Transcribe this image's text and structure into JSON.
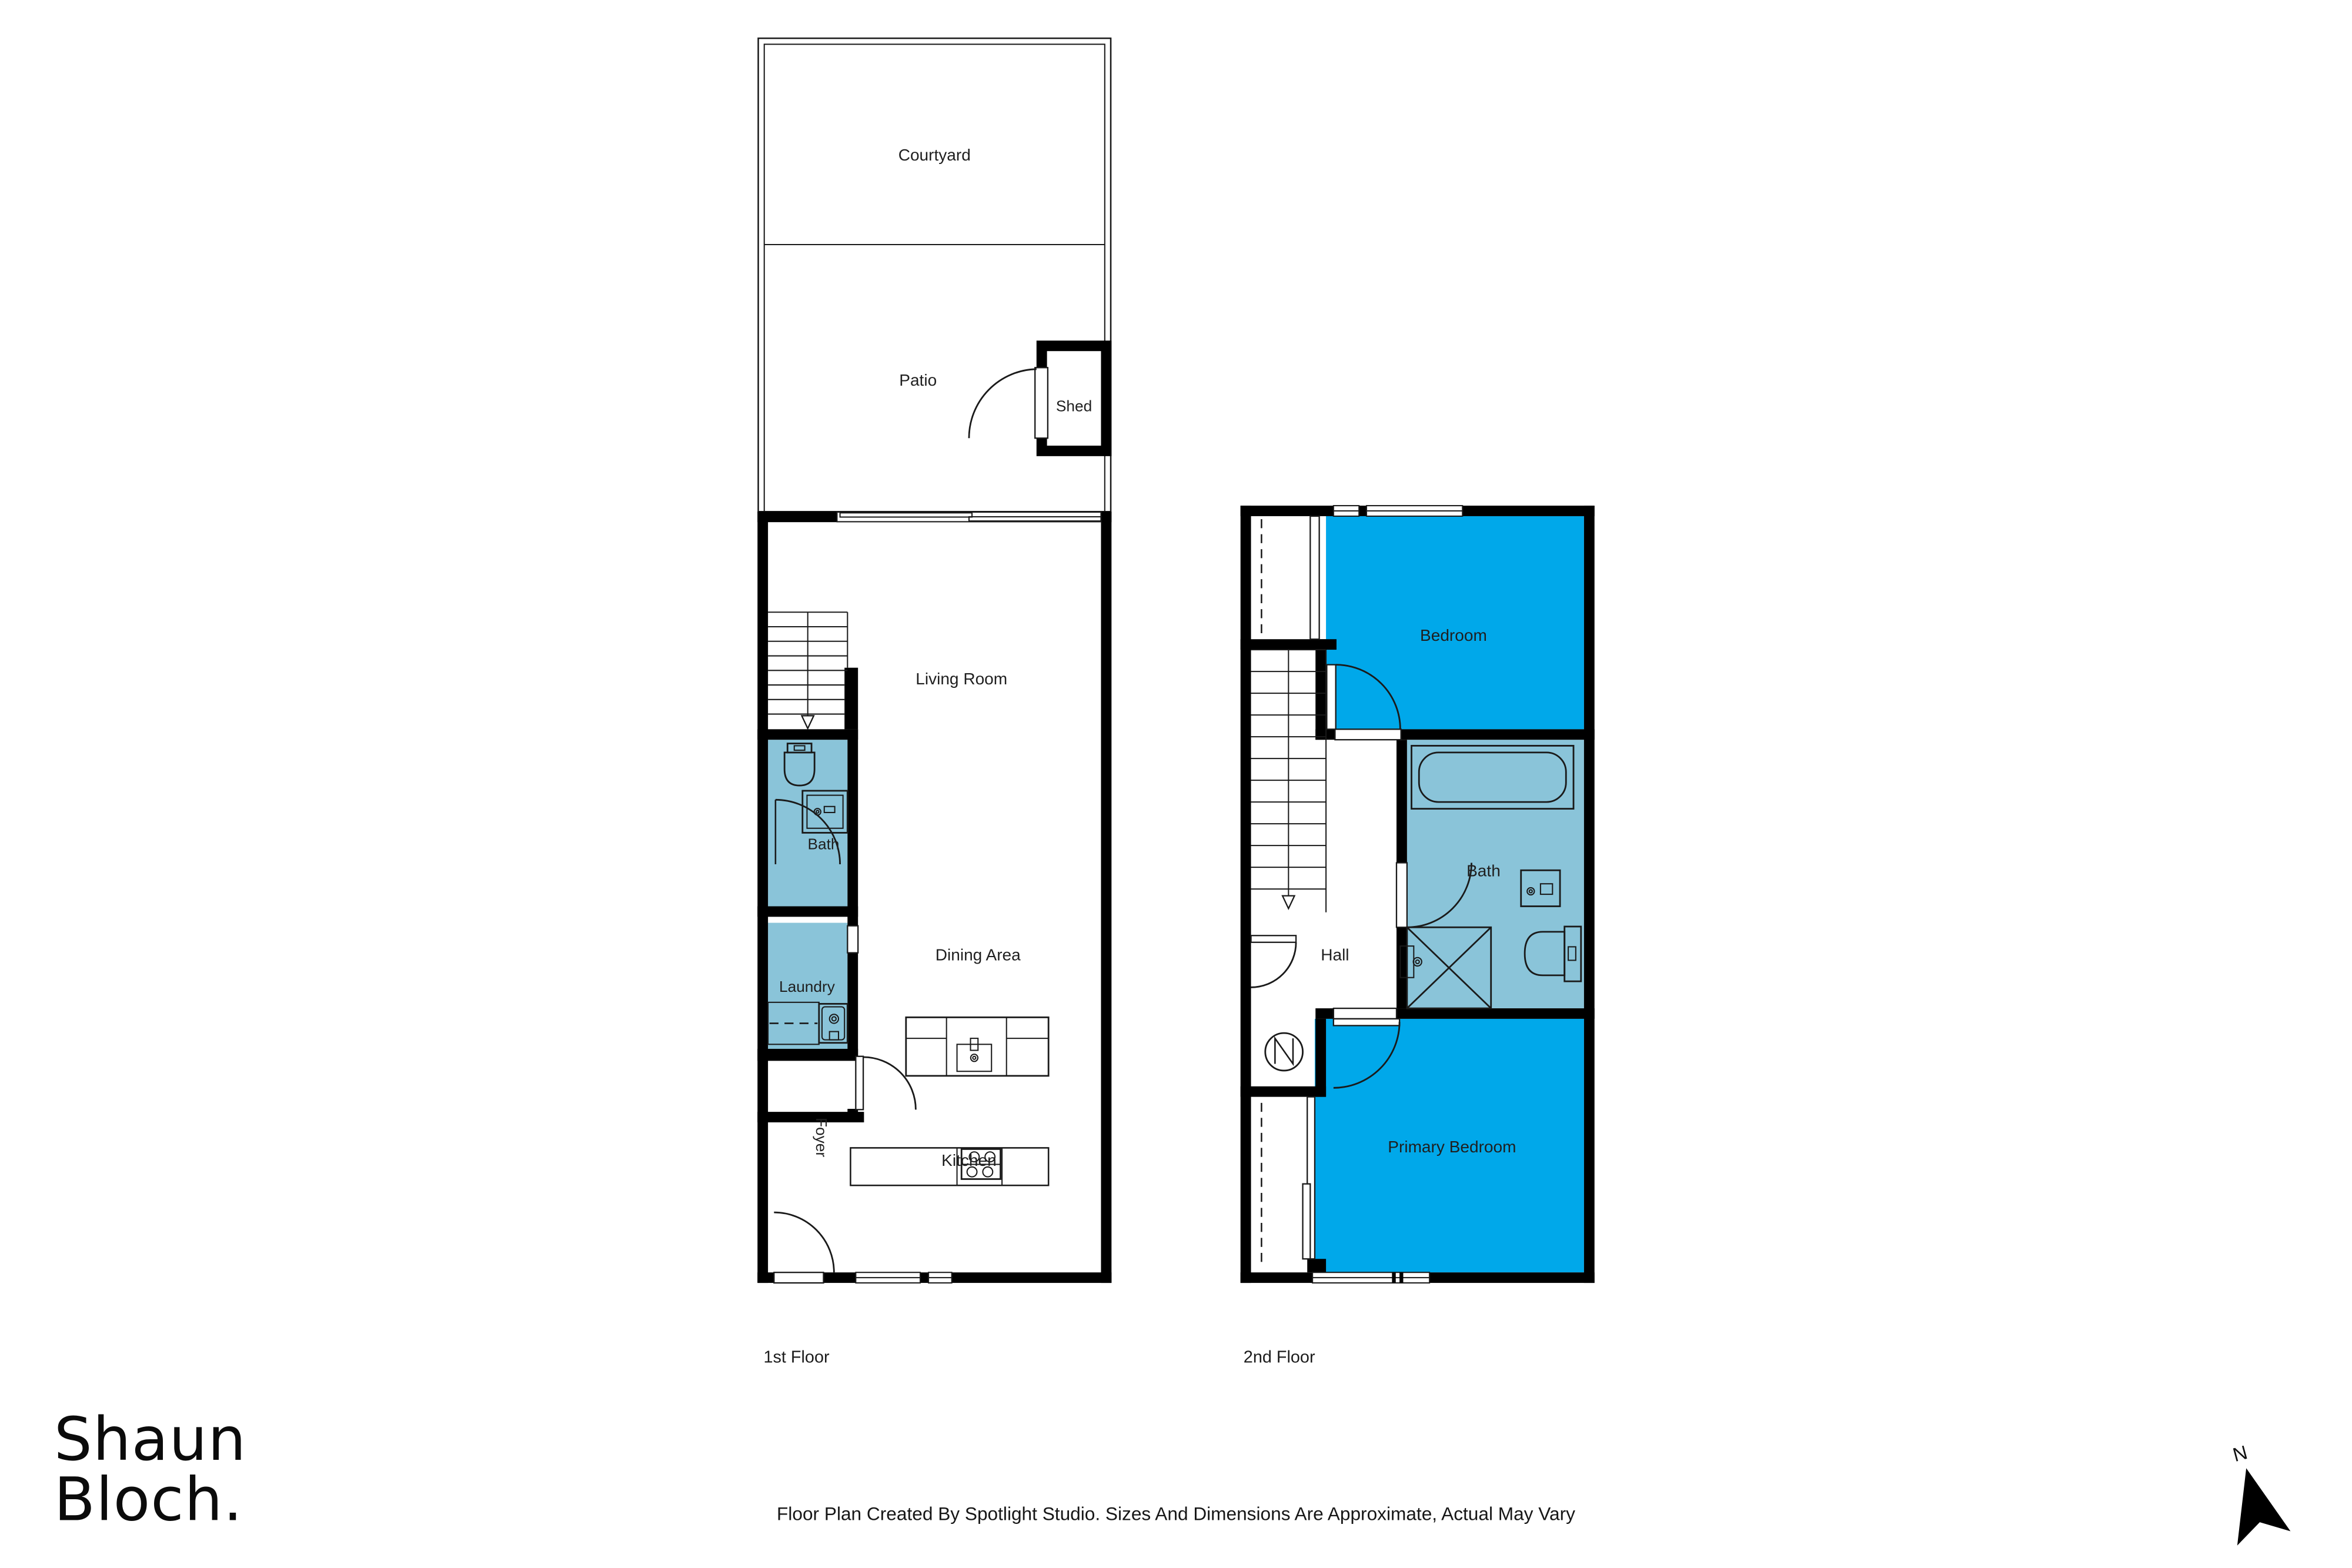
{
  "page": {
    "background": "#ffffff"
  },
  "colors": {
    "room_highlight": "#00A8EA",
    "wet_room": "#8AC4D9",
    "walls": "#000000"
  },
  "floor1": {
    "caption": "1st Floor",
    "rooms": {
      "courtyard": "Courtyard",
      "patio": "Patio",
      "shed": "Shed",
      "living_room": "Living Room",
      "bath": "Bath",
      "laundry": "Laundry",
      "dining": "Dining Area",
      "kitchen": "Kitchen",
      "foyer": "Foyer"
    }
  },
  "floor2": {
    "caption": "2nd Floor",
    "rooms": {
      "bedroom": "Bedroom",
      "hall": "Hall",
      "bath": "Bath",
      "primary_bedroom": "Primary Bedroom"
    }
  },
  "branding": {
    "logo_line1": "Shaun",
    "logo_line2": "Bloch."
  },
  "footer": {
    "disclaimer": "Floor Plan Created By Spotlight Studio. Sizes And Dimensions Are Approximate, Actual May Vary"
  },
  "compass": {
    "label": "N"
  }
}
